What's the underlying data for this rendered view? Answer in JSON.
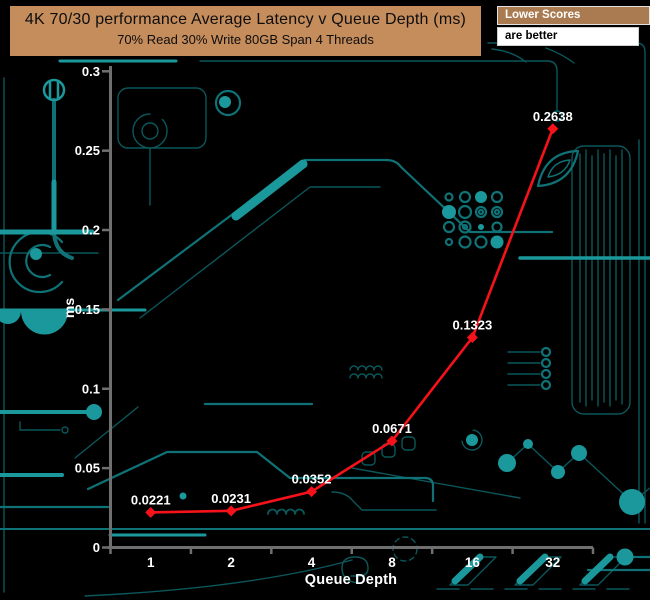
{
  "header": {
    "title_line1": "4K 70/30 performance Average Latency v Queue Depth (ms)",
    "title_line2": "70% Read 30% Write 80GB Span 4 Threads"
  },
  "legend": {
    "header": "Lower Scores",
    "body": "are better"
  },
  "chart_data": {
    "type": "line",
    "title": "4K 70/30 performance Average Latency v Queue Depth (ms)",
    "subtitle": "70% Read 30% Write 80GB Span 4 Threads",
    "categories": [
      "1",
      "2",
      "4",
      "8",
      "16",
      "32"
    ],
    "series": [
      {
        "name": "Average Latency",
        "values": [
          0.0221,
          0.0231,
          0.0352,
          0.0671,
          0.1323,
          0.2638
        ],
        "color": "#f5121b",
        "marker": "diamond"
      }
    ],
    "data_labels": [
      "0.0221",
      "0.0231",
      "0.0352",
      "0.0671",
      "0.1323",
      "0.2638"
    ],
    "xlabel": "Queue Depth",
    "ylabel": "ms",
    "ylim": [
      0,
      0.3
    ],
    "yticks": [
      0,
      0.05,
      0.1,
      0.15,
      0.2,
      0.25,
      0.3
    ],
    "ytick_labels": [
      "0",
      "0.05",
      "0.1",
      "0.15",
      "0.2",
      "0.25",
      "0.3"
    ],
    "grid": false,
    "legend_position": "top-right"
  },
  "colors": {
    "background": "#000000",
    "title_box": "#c58c5c",
    "legend_header_bg": "#aa7b50",
    "legend_body_bg": "#ffffff",
    "axis": "#6f6f6f",
    "tick_text": "#ffffff",
    "series_red": "#f5121b",
    "circuit_dim": "#0b575b",
    "circuit_mid": "#0f7276",
    "circuit_bright": "#1b989c"
  }
}
